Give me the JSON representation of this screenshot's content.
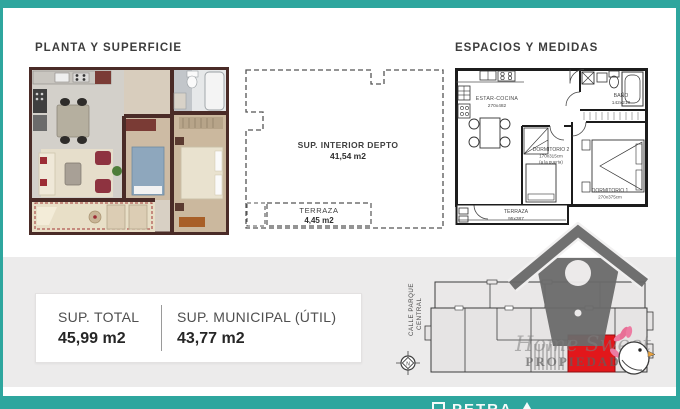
{
  "headings": {
    "left": "PLANTA Y SUPERFICIE",
    "right": "ESPACIOS Y MEDIDAS"
  },
  "outline_plan": {
    "interior_name": "SUP. INTERIOR DEPTO",
    "interior_area": "41,54 m2",
    "terrace_name": "TERRAZA",
    "terrace_area": "4,45 m2"
  },
  "measured_plan": {
    "rooms": [
      {
        "name": "ESTAR-COCINA",
        "dims": "270x482"
      },
      {
        "name": "BAÑO",
        "dims": "142x210"
      },
      {
        "name": "DORMITORIO 2",
        "dims": "170x315cm",
        "note": "(a la puerta)"
      },
      {
        "name": "DORMITORIO 1",
        "dims": "270x375cm"
      },
      {
        "name": "TERRAZA",
        "dims": "95x387"
      }
    ]
  },
  "summary_card": {
    "total_label": "SUP. TOTAL",
    "total_value": "45,99 m2",
    "municipal_label": "SUP. MUNICIPAL (ÚTIL)",
    "municipal_value": "43,77 m2"
  },
  "site_plan": {
    "street_line1": "CALLE PARQUE",
    "street_line2": "CENTRAL",
    "compass_letter": "N"
  },
  "watermark": {
    "script_text": "Home Sweet",
    "caps_text": "PROPIEDADES"
  },
  "footer": {
    "partial_text": "PETRA"
  },
  "colors": {
    "teal": "#2ea69e",
    "band": "#ecebeb",
    "highlight": "#e2171b"
  },
  "icons": [
    "birdhouse-logo-icon",
    "compass-icon",
    "bird-mascot-icon",
    "footer-logo-partial"
  ]
}
